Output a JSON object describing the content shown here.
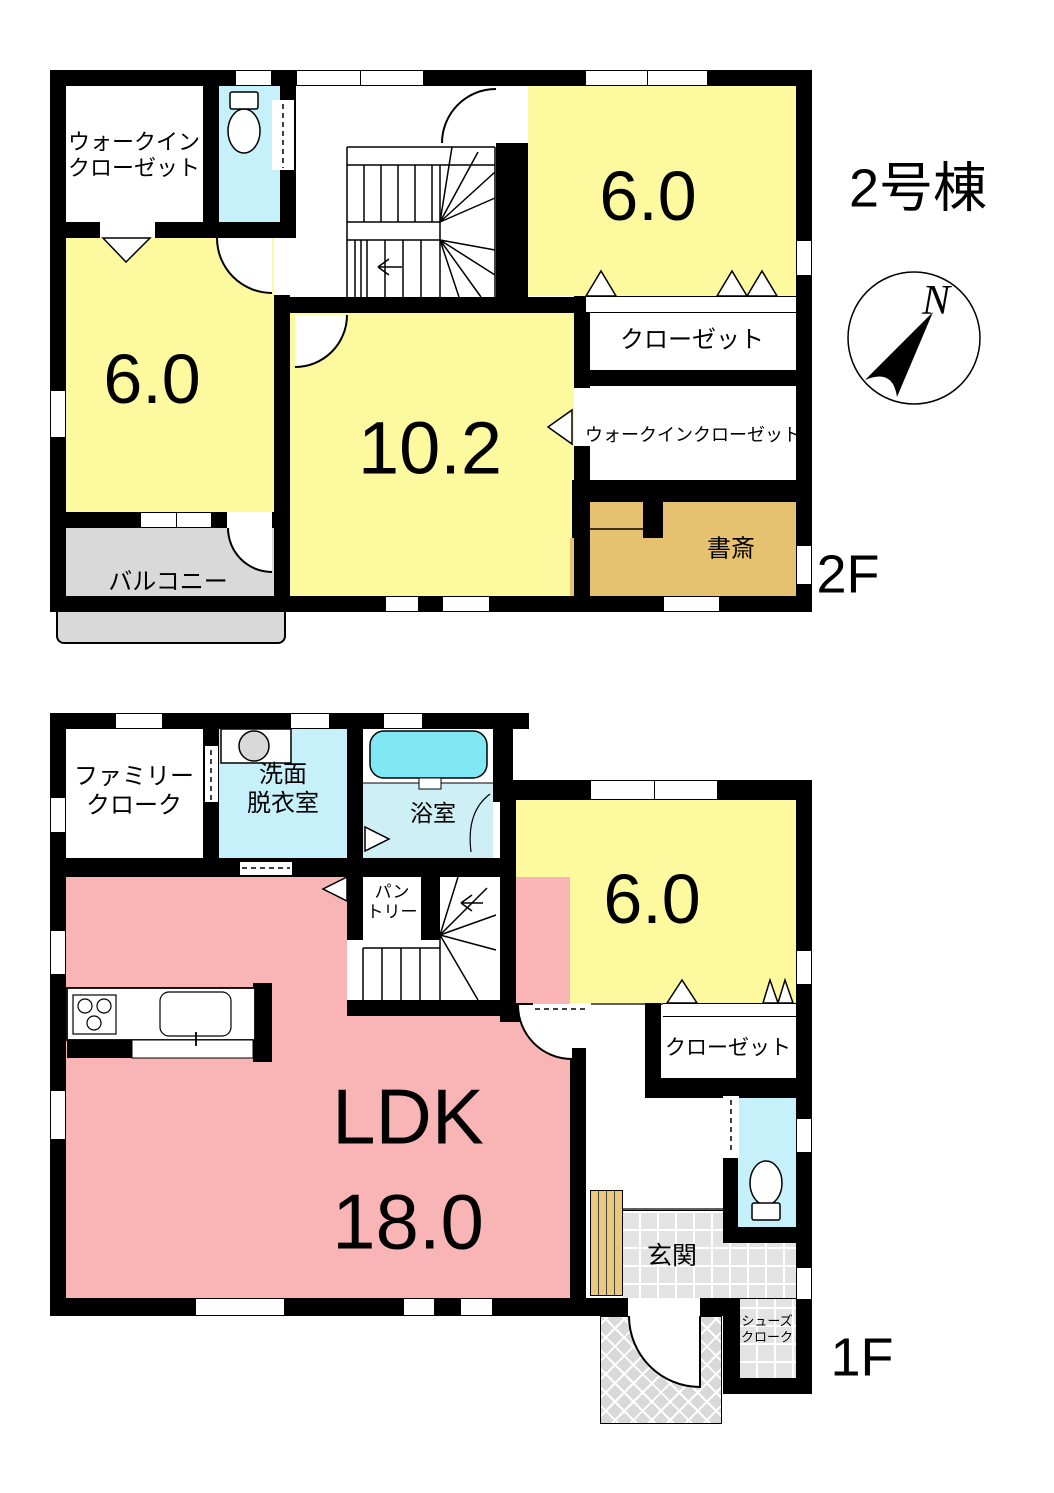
{
  "title": "2号棟",
  "compass": {
    "north": "N"
  },
  "floor2": {
    "floor_label": "2F",
    "walk_in_closet": [
      "ウォークイン",
      "クローゼット"
    ],
    "bedroom_ne": "6.0",
    "bedroom_w": "6.0",
    "bedroom_main": "10.2",
    "closet": "クローゼット",
    "walk_in_closet_e": "ウォークインクローゼット",
    "study": "書斎",
    "balcony": "バルコニー"
  },
  "floor1": {
    "floor_label": "1F",
    "family_cloak": [
      "ファミリー",
      "クローク"
    ],
    "washroom": [
      "洗面",
      "脱衣室"
    ],
    "bathroom": "浴室",
    "pantry": [
      "パン",
      "トリー"
    ],
    "bedroom": "6.0",
    "closet": "クローゼット",
    "ldk": [
      "LDK",
      "18.0"
    ],
    "entrance": "玄関",
    "shoe_cloak": [
      "シューズ",
      "クローク"
    ]
  },
  "colors": {
    "wall": "#000000",
    "room_yellow": "#FDF99E",
    "room_pink": "#F9B5B5",
    "room_cyan": "#C7F1FA",
    "bath_floor": "#CDEFF5",
    "bathtub": "#7FE8F2",
    "study_tan": "#E6C170",
    "balcony_gray": "#D9D9D9",
    "tile_gray": "#E3E3E3",
    "wood": "#EAC87E",
    "appliance_gray": "#D9D9D9"
  }
}
